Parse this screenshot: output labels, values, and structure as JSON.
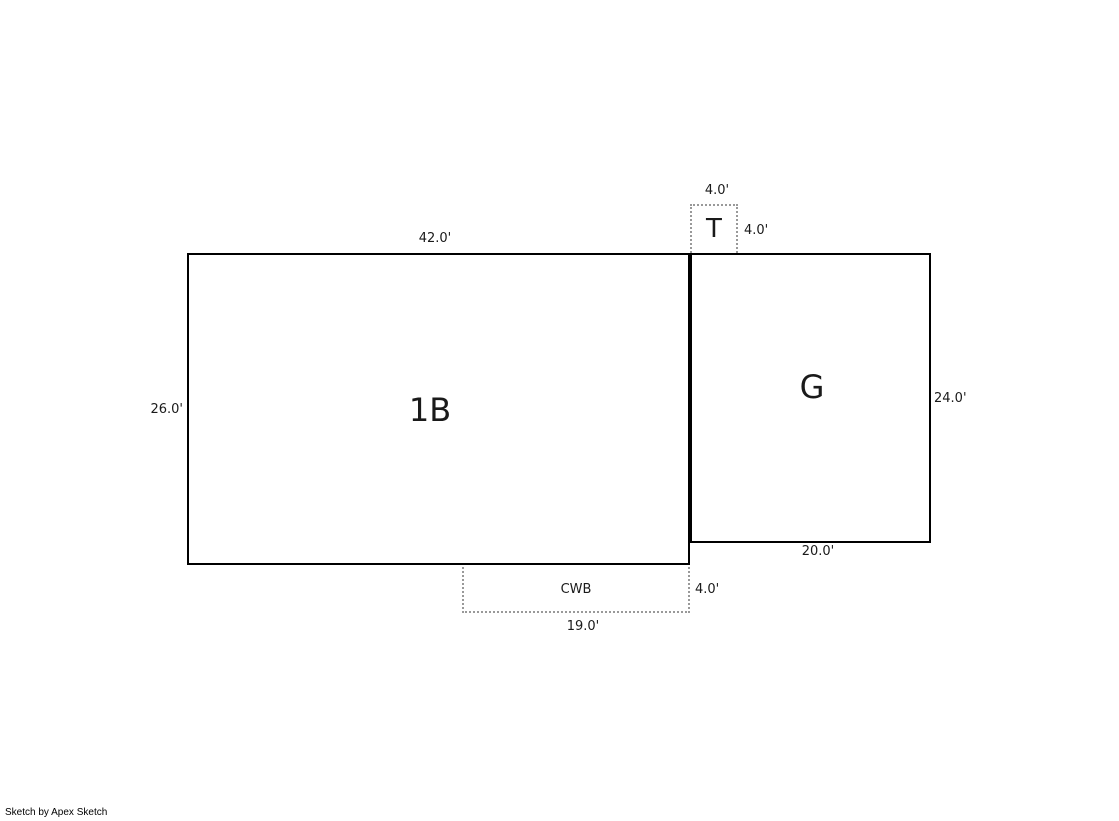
{
  "page": {
    "footer": "Sketch by Apex Sketch"
  },
  "colors": {
    "background": "#ffffff",
    "solid_line": "#000000",
    "dotted_line": "#999999",
    "label_text": "#1a1a1a"
  },
  "areas": {
    "area_1b": {
      "label": "1B",
      "dim_top": "42.0'",
      "dim_left": "26.0'"
    },
    "area_g": {
      "label": "G",
      "dim_right": "24.0'",
      "dim_bottom": "20.0'"
    },
    "area_t": {
      "label": "T",
      "dim_top": "4.0'",
      "dim_right": "4.0'"
    },
    "area_cwb": {
      "label": "CWB",
      "dim_right": "4.0'",
      "dim_bottom": "19.0'"
    }
  }
}
